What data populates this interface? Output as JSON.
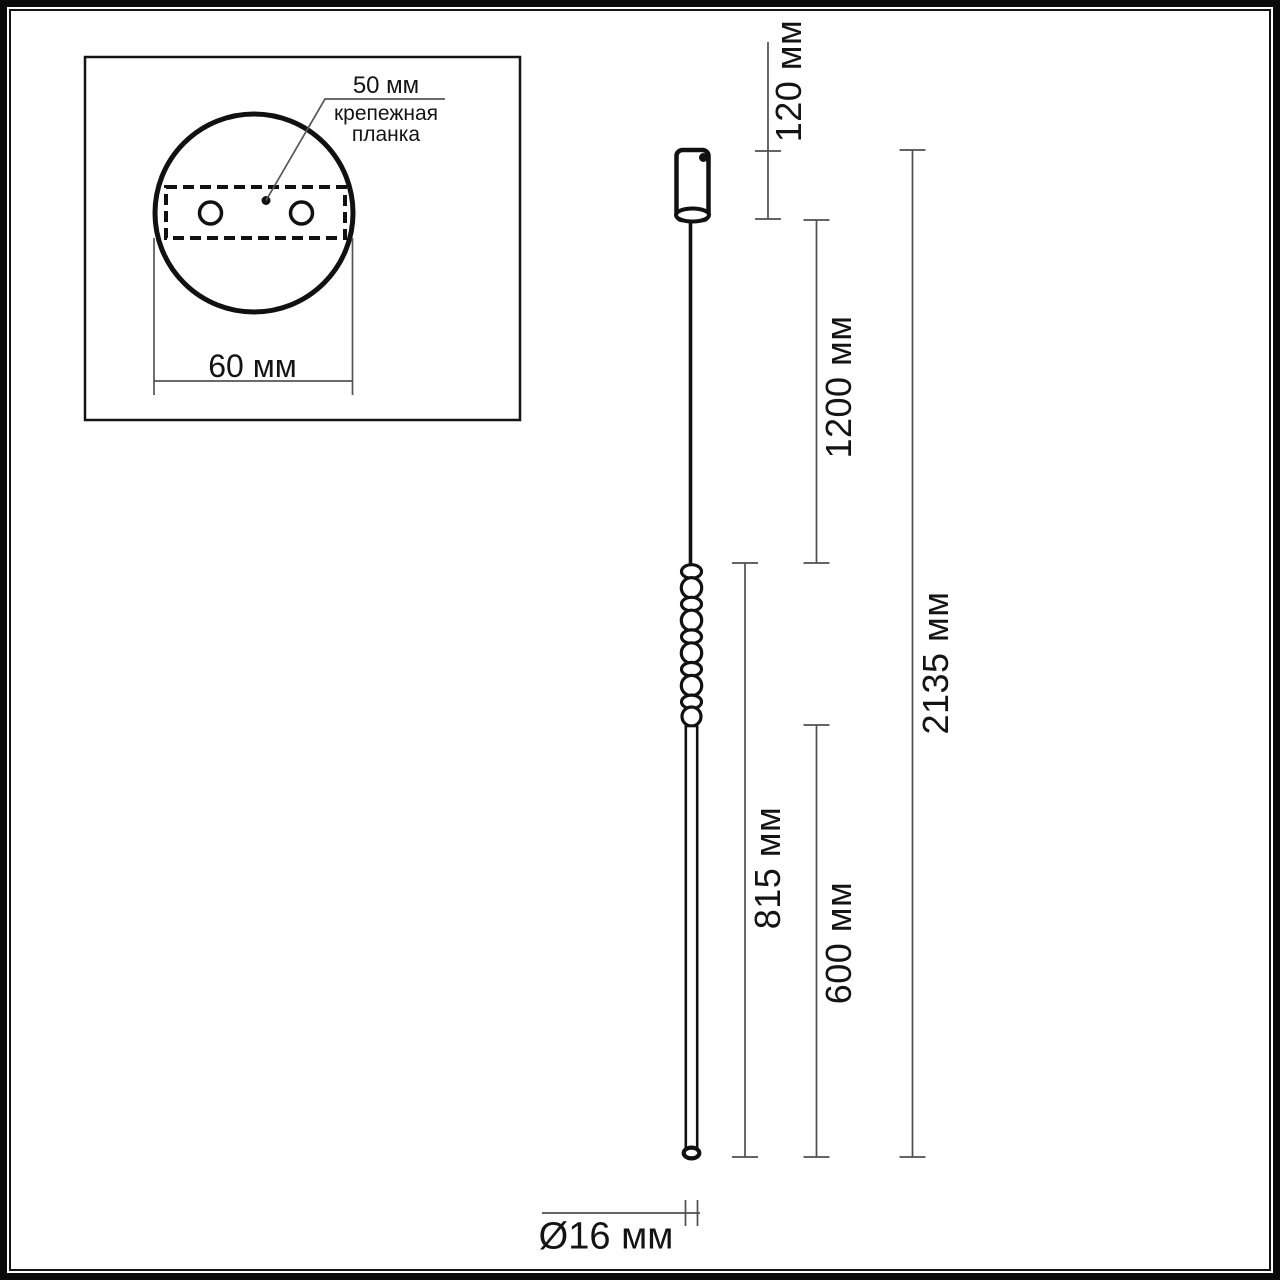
{
  "drawing": {
    "type": "pendant-lamp-dimensional-drawing",
    "colors": {
      "outline": "#111111",
      "dimension_line": "#4f4f4f",
      "text": "#141414",
      "background": "#ffffff"
    },
    "inset": {
      "bracket_dim": "50 мм",
      "bracket_label": "крепежная планка",
      "base_dim": "60 мм"
    },
    "dims": {
      "canopy_height": "120 мм",
      "suspension_length": "1200 мм",
      "overall_height": "2135 мм",
      "fixture_length": "815 мм",
      "tube_length": "600 мм",
      "tube_diameter": "Ø16 мм"
    }
  }
}
